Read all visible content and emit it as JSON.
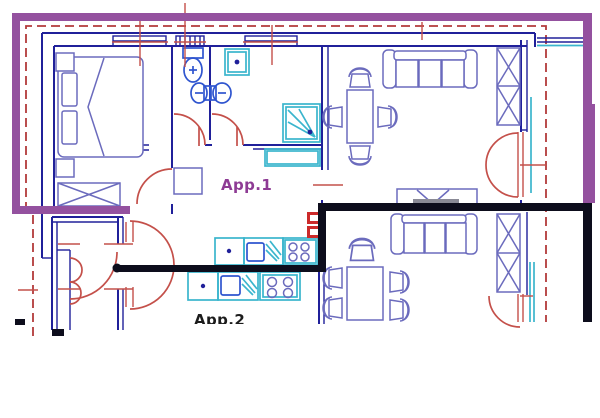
{
  "drawing": {
    "labels": {
      "apartment1": "App.1",
      "apartment2": "App.2"
    },
    "colors": {
      "boundary_purple": "#94519f",
      "dashed_red": "#b23a3a",
      "wall_navy": "#20209a",
      "furniture_navy": "#6b6bbd",
      "fixture_blue": "#2f55cf",
      "sanitary_cyan": "#3ab5cd",
      "door_red": "#c4504a",
      "demolition_black": "#0d0d1c",
      "panel_red": "#cc2a2a",
      "tv_gray": "#8a8a96",
      "label1_purple": "#8e3b94",
      "label2_black": "#1c1c1c"
    }
  }
}
